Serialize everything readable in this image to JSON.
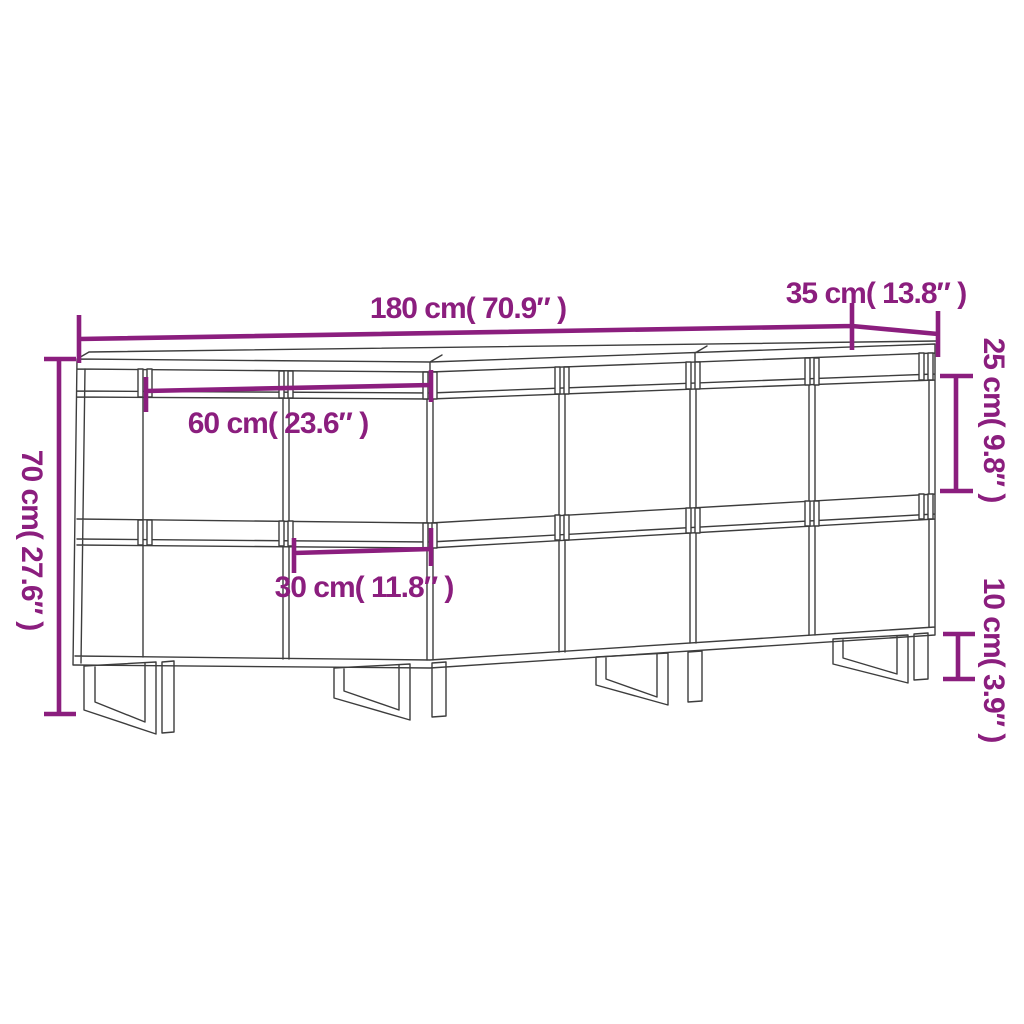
{
  "figure": {
    "kind": "furniture-dimension-line-drawing",
    "colors": {
      "background": "#ffffff",
      "outline": "#3d3d3d",
      "dimension": "#8b1e7e"
    },
    "labels": {
      "total_width": "180 cm( 70.9″ )",
      "depth": "35 cm( 13.8″ )",
      "height": "70 cm( 27.6″ )",
      "upper_door_height": "25 cm( 9.8″ )",
      "leg_height": "10 cm( 3.9″ )",
      "unit_width": "60 cm( 23.6″ )",
      "door_width": "30 cm( 11.8″ )"
    }
  }
}
